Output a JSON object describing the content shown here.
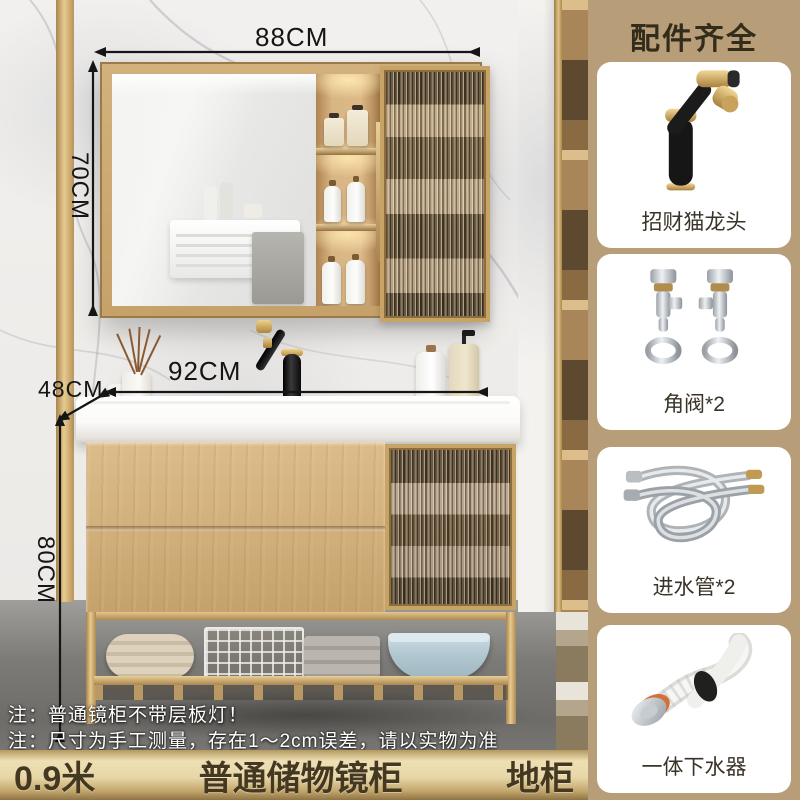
{
  "product": {
    "dimensions": {
      "mirror_width": "88CM",
      "mirror_height": "70CM",
      "depth": "48CM",
      "counter_width": "92CM",
      "cabinet_height": "80CM"
    },
    "notes": {
      "line1": "注：普通镜柜不带层板灯！",
      "line2": "注：尺寸为手工测量，存在1～2cm误差，请以实物为准"
    },
    "bottom_bar": {
      "size": "0.9米",
      "center": "普通储物镜柜",
      "right": "地柜"
    }
  },
  "sidebar": {
    "title": "配件齐全",
    "items": [
      {
        "label": "招财猫龙头",
        "icon": "faucet-icon"
      },
      {
        "label": "角阀*2",
        "icon": "angle-valve-icon"
      },
      {
        "label": "进水管*2",
        "icon": "inlet-hose-icon"
      },
      {
        "label": "一体下水器",
        "icon": "drain-pipe-icon"
      }
    ]
  },
  "colors": {
    "sidebar_bg": "#b89e78",
    "gold_bar": "#e7d7a8",
    "accent_gold": "#c7a465",
    "bar_text": "#443821",
    "wood": "#d2b07b"
  }
}
